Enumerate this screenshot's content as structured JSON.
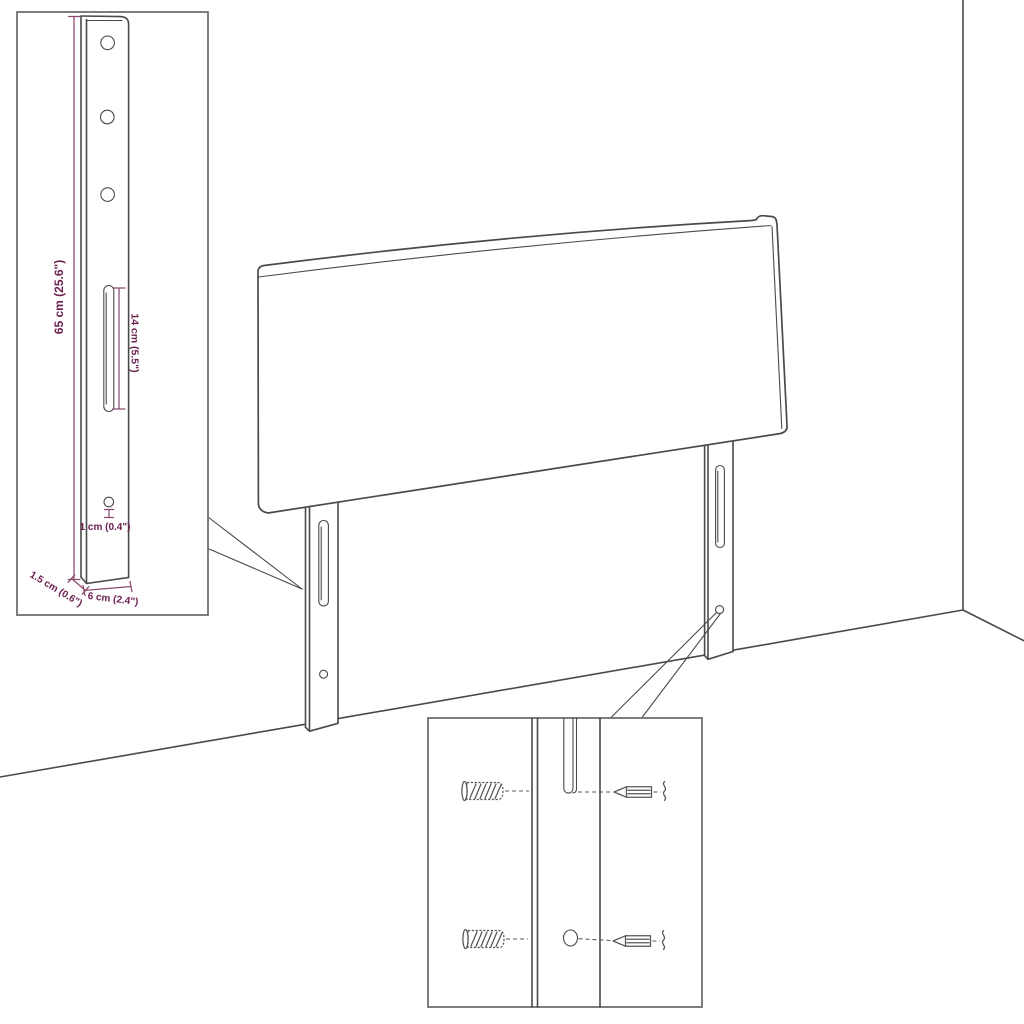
{
  "diagram": {
    "subject": "headboard-with-wall-mount-legs-dimension-diagram",
    "labels": {
      "leg_height": "65 cm (25.6\")",
      "slot_length": "14 cm (5.5\")",
      "hole_size": "1 cm (0.4\")",
      "leg_depth": "1.5 cm (0.6\")",
      "leg_width": "6 cm (2.4\")"
    },
    "colors": {
      "drawing_line": "#4a4a4a",
      "dimension_text": "#6b2050",
      "dimension_line": "#8a4a6f",
      "background": "#ffffff"
    },
    "icons": [
      "headboard-panel-icon",
      "mounting-leg-icon",
      "wall-plug-icon",
      "screw-icon",
      "room-corner-icon"
    ]
  }
}
